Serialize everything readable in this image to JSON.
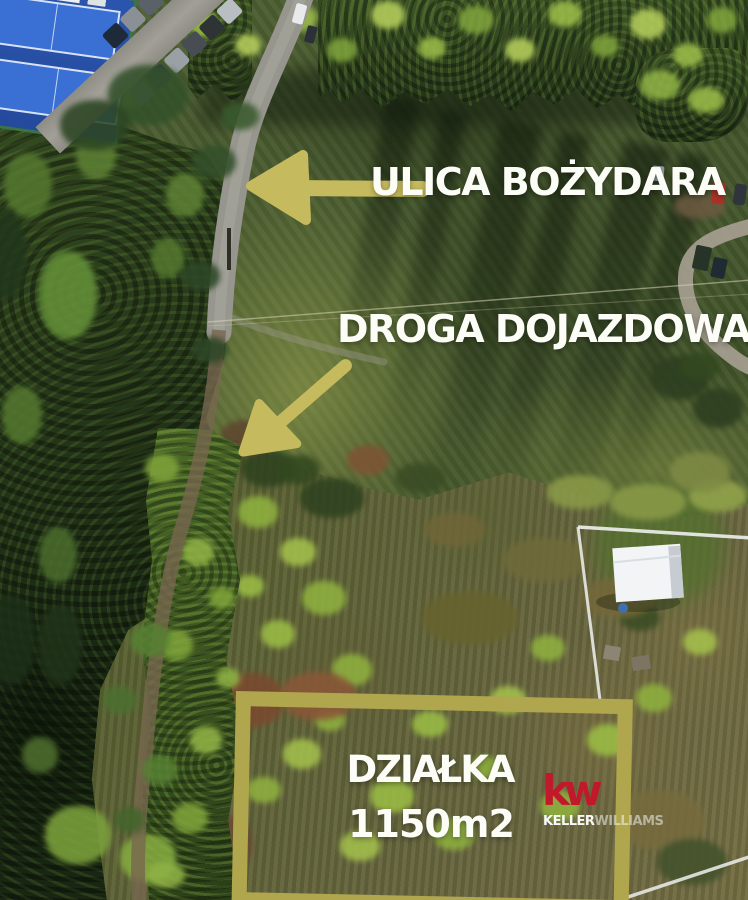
{
  "annotations": {
    "street": "ULICA BOŻYDARA",
    "access_road": "DROGA DOJAZDOWA",
    "plot_name": "DZIAŁKA",
    "plot_area": "1150m2"
  },
  "logo": {
    "symbol": "kw",
    "brand_first": "KELLER",
    "brand_second": "WILLIAMS"
  },
  "colors": {
    "annotation_olive": "#b0a64e",
    "arrow_olive": "#c6ba5e",
    "label_white": "#fdfdf8",
    "kw_red": "#c1182a",
    "court_blue": "#3a6fd4"
  }
}
